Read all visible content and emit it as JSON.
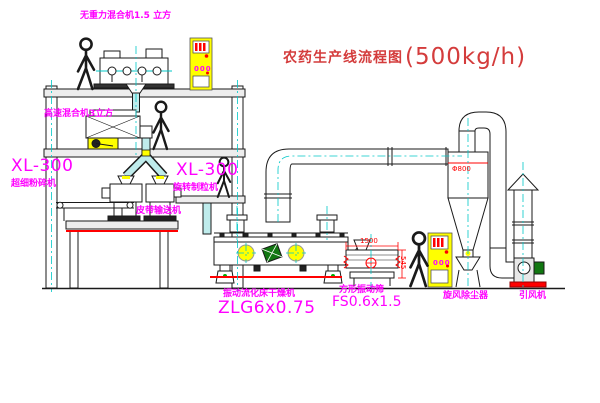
{
  "title": {
    "text_cn": "农药生产线流程图",
    "capacity": "(500kg/h)"
  },
  "equipment_labels": {
    "gravity_mixer": "无重力混合机1.5 立方",
    "high_speed_mixer": "高速混合机3立方",
    "crusher_model": "XL-300",
    "crusher_name": "超细粉碎机",
    "granulator_model": "XL-300",
    "granulator_name": "旋转制粒机",
    "belt_conveyor": "皮带输送机",
    "dryer_name": "振动流化床干燥机",
    "dryer_model": "ZLG6x0.75",
    "sieve_name": "方形振动筛",
    "sieve_model": "FS0.6x1.5",
    "cyclone_name": "旋风除尘器",
    "fan_name": "引风机"
  },
  "annotations": {
    "cyclone_dim": "Φ800",
    "sieve_length_dim": "1500",
    "sieve_height_dim": "545",
    "cabinet_display": "000"
  },
  "colors": {
    "label_magenta": "#ff00ff",
    "title_red": "#d43c3c",
    "dim_red": "#ff0000",
    "centerline_cyan": "#00c8c8",
    "cabinet_yellow": "#ffff00",
    "pipe_teal": "#bfecec",
    "motor_green": "#117711"
  }
}
